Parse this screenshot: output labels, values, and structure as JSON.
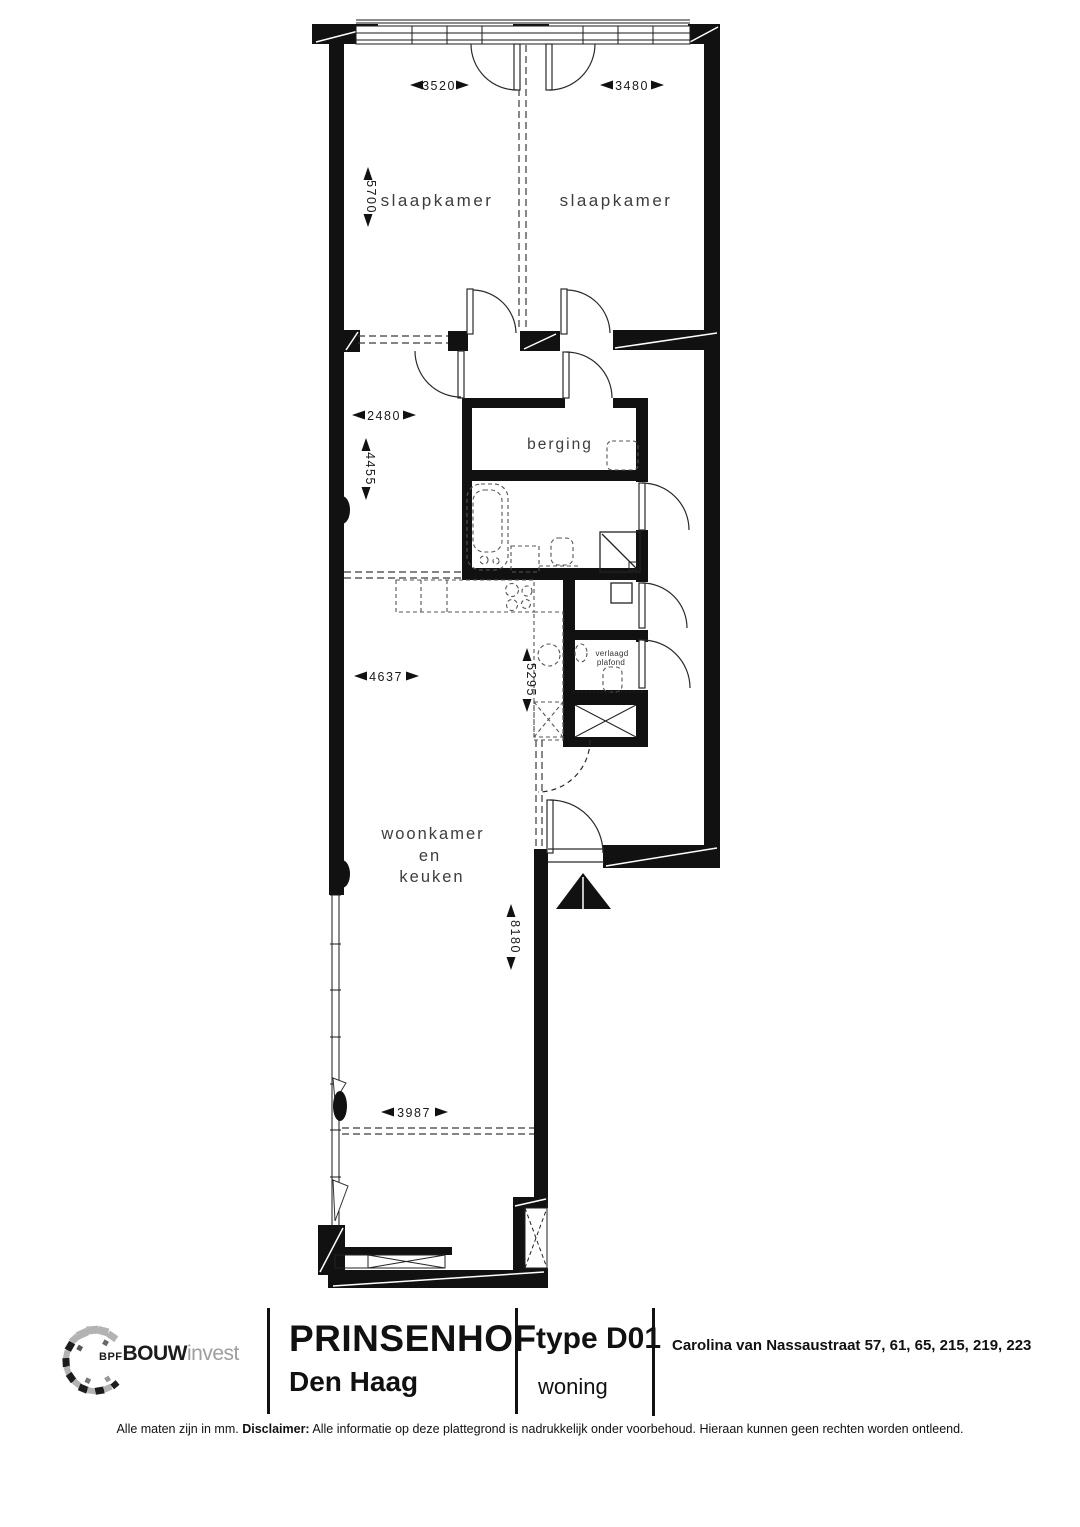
{
  "plan": {
    "rooms": {
      "bedroom_left": "slaapkamer",
      "bedroom_right": "slaapkamer",
      "storage": "berging",
      "living_1": "woonkamer",
      "living_2": "en",
      "living_3": "keuken",
      "ceiling_1": "verlaagd",
      "ceiling_2": "plafond"
    },
    "dims": {
      "d3520": "3520",
      "d3480": "3480",
      "d5700": "5700",
      "d2480": "2480",
      "d4455": "4455",
      "d4637": "4637",
      "d5295": "5295",
      "d8180": "8180",
      "d3987": "3987"
    }
  },
  "footer": {
    "logo": {
      "bpf": "BPF",
      "bouw": "BOUW",
      "invest": "invest"
    },
    "project": {
      "name": "PRINSENHOF",
      "city": "Den Haag"
    },
    "unit": {
      "type": "type D01",
      "kind": "woning"
    },
    "address": "Carolina van Nassaustraat 57, 61, 65, 215, 219, 223",
    "disclaimer": {
      "prefix": "Alle maten zijn in mm.",
      "label": "Disclaimer:",
      "text": "Alle informatie op deze plattegrond is nadrukkelijk onder voorbehoud. Hieraan kunnen geen rechten worden ontleend."
    }
  },
  "colors": {
    "wall": "#111111",
    "logo_gray": "#b3b3b3",
    "label": "#3d3d3d"
  }
}
